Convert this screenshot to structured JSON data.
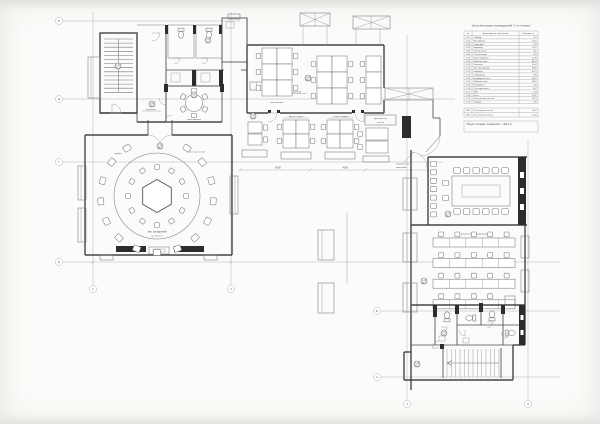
{
  "meta": {
    "drawing_type": "floor-plan",
    "style": "scanned blueprint, monochrome"
  },
  "colors": {
    "paper": "#fbfbf9",
    "thin_line": "#74787c",
    "wall_line": "#43464a",
    "filled_wall": "#2a2c2e",
    "grid_line": "#a8adb2",
    "text": "#4b4f53"
  },
  "legend": {
    "title": "Экспликация помещений 1-го этажа",
    "headers": [
      "№",
      "Наименование помещения",
      "Площадь, м²"
    ],
    "rows": [
      [
        "1.01",
        "Тамбур",
        "3,2"
      ],
      [
        "1.02",
        "Вестибюль",
        "22,6"
      ],
      [
        "1.03",
        "Гардероб",
        "7,4"
      ],
      [
        "1.04",
        "Коридор",
        "18,9"
      ],
      [
        "1.05",
        "С/у мужской",
        "4,1"
      ],
      [
        "1.06",
        "С/у женский",
        "4,3"
      ],
      [
        "1.07",
        "Переговорная",
        "12,8"
      ],
      [
        "1.08",
        "Рабочая зона",
        "86,4"
      ],
      [
        "1.09",
        "Ресепшн",
        "14,2"
      ],
      [
        "1.10",
        "Зал заседаний",
        "98,6"
      ],
      [
        "1.11",
        "Коридор",
        "42,3"
      ],
      [
        "1.12",
        "Серверная",
        "6,8"
      ],
      [
        "1.13",
        "Конференц-зал",
        "38,2"
      ],
      [
        "1.14",
        "Рабочая зона",
        "64,5"
      ],
      [
        "1.15",
        "Кладовая",
        "3,6"
      ],
      [
        "1.16",
        "С/у персонала",
        "8,2"
      ],
      [
        "1.17",
        "КУИ",
        "2,4"
      ],
      [
        "1.18",
        "Холл",
        "12,1"
      ],
      [
        "1.19",
        "Лестничная клетка",
        "15,3"
      ],
      [
        "1.20",
        "Тамбур",
        "2,8"
      ]
    ],
    "footer_rows": [
      [
        "ЛК1",
        "Лестничная клетка",
        "16,2"
      ],
      [
        "ЛК2",
        "Лестничная клетка",
        "15,8"
      ]
    ],
    "note": "Общая площадь помещений — 482,2 м²"
  },
  "labels": {
    "round_hall": "зал заседаний",
    "round_hall_seats": "на 26 мест",
    "hex_table": "президиум",
    "hall_left": "трибуна",
    "hall_right": "места делегатов",
    "bank_a": "менеджеры",
    "bank_b": "специалисты",
    "cluster_1": "бухгалтерия",
    "cluster_2": "отдел кадров",
    "right_office": "размещение сотрудников",
    "reception": "ресепшн",
    "wardrobe": "гардероб",
    "meeting_small": "переговорная",
    "head_desk_line1": "руководитель",
    "head_desk_line2": "отдела",
    "note_line1": "направление",
    "note_line2": "эвакуации",
    "dim1": "6000",
    "dim2": "4500"
  },
  "grid": {
    "row_bubbles": [
      {
        "label": "Е",
        "x": 59,
        "y": 21
      },
      {
        "label": "Д",
        "x": 59,
        "y": 99
      },
      {
        "label": "Г",
        "x": 59,
        "y": 162
      },
      {
        "label": "В",
        "x": 59,
        "y": 262
      },
      {
        "label": "Б",
        "x": 377,
        "y": 311
      },
      {
        "label": "А",
        "x": 377,
        "y": 377
      }
    ],
    "col_bubbles": [
      {
        "label": "1",
        "x": 93,
        "y": 289
      },
      {
        "label": "2",
        "x": 231,
        "y": 289
      },
      {
        "label": "3",
        "x": 407,
        "y": 404
      },
      {
        "label": "4",
        "x": 528,
        "y": 404
      }
    ]
  },
  "plan": {
    "room_tags": [
      {
        "num": "1.19",
        "area": "15,3",
        "x": 118,
        "y": 66
      },
      {
        "num": "1.04",
        "area": "18,9",
        "x": 152,
        "y": 104
      },
      {
        "num": "1.05",
        "area": "4,1",
        "x": 208,
        "y": 40
      },
      {
        "num": "1.07",
        "area": "12,8",
        "x": 194,
        "y": 95
      },
      {
        "num": "1.08",
        "area": "86,4",
        "x": 308,
        "y": 78
      },
      {
        "num": "1.02",
        "area": "22,6",
        "x": 253,
        "y": 116
      },
      {
        "num": "1.10",
        "area": "98,6",
        "x": 160,
        "y": 146
      },
      {
        "num": "1.13",
        "area": "38,2",
        "x": 448,
        "y": 214
      },
      {
        "num": "1.14",
        "area": "64,5",
        "x": 424,
        "y": 281
      },
      {
        "num": "1.16",
        "area": "8,2",
        "x": 444,
        "y": 333
      },
      {
        "num": "1.18",
        "area": "12,1",
        "x": 417,
        "y": 364
      }
    ]
  }
}
